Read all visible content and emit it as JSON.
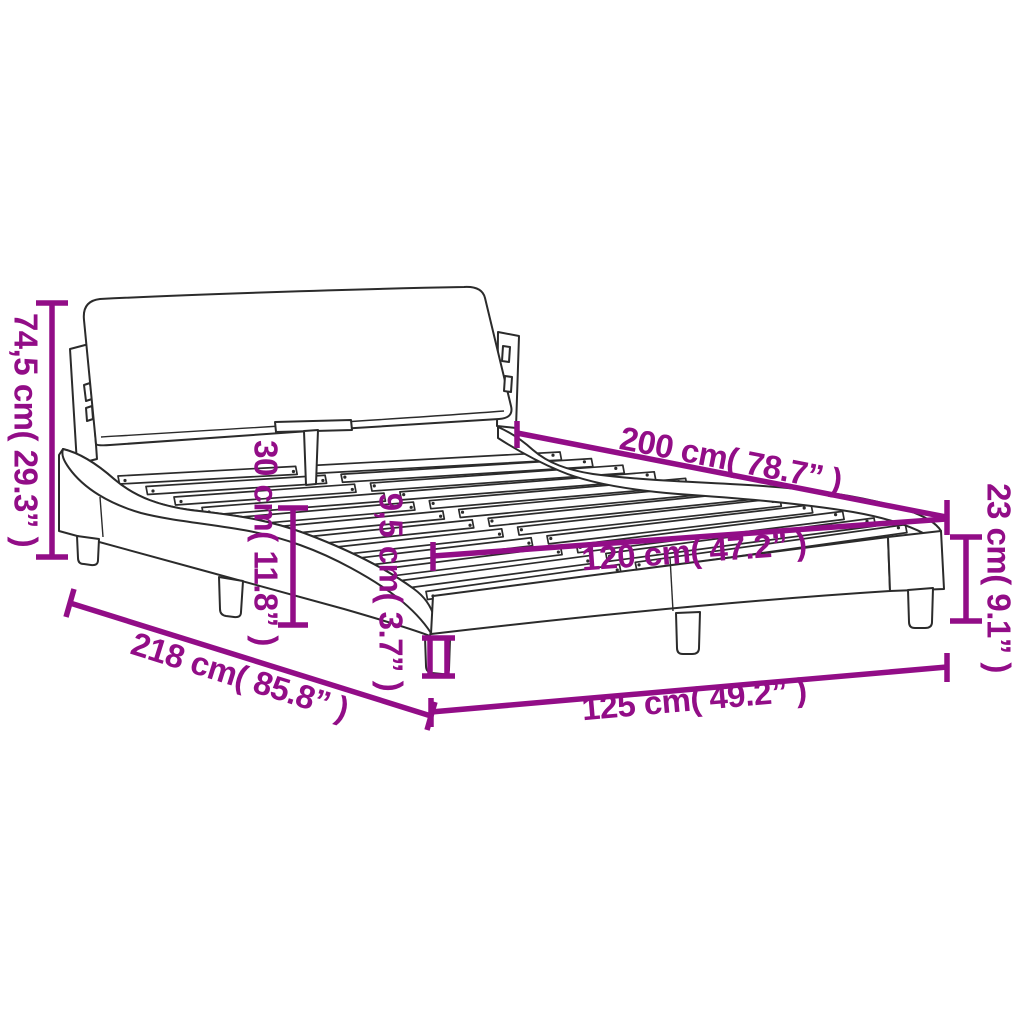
{
  "diagram": {
    "accent_color": "#920d87",
    "outline_color": "#2b2b2b",
    "background_color": "#ffffff",
    "dimensions": {
      "total_height": "74,5 cm( 29.3” )",
      "headboard_height": "30 cm( 11.8” )",
      "slat_depth": "9,5 cm( 3.7” )",
      "mattress_length": "200 cm( 78.7” )",
      "frame_height": "23 cm( 9.1” )",
      "mattress_width": "120 cm( 47.2” )",
      "total_length": "218 cm( 85.8” )",
      "total_width": "125 cm( 49.2” )"
    }
  }
}
